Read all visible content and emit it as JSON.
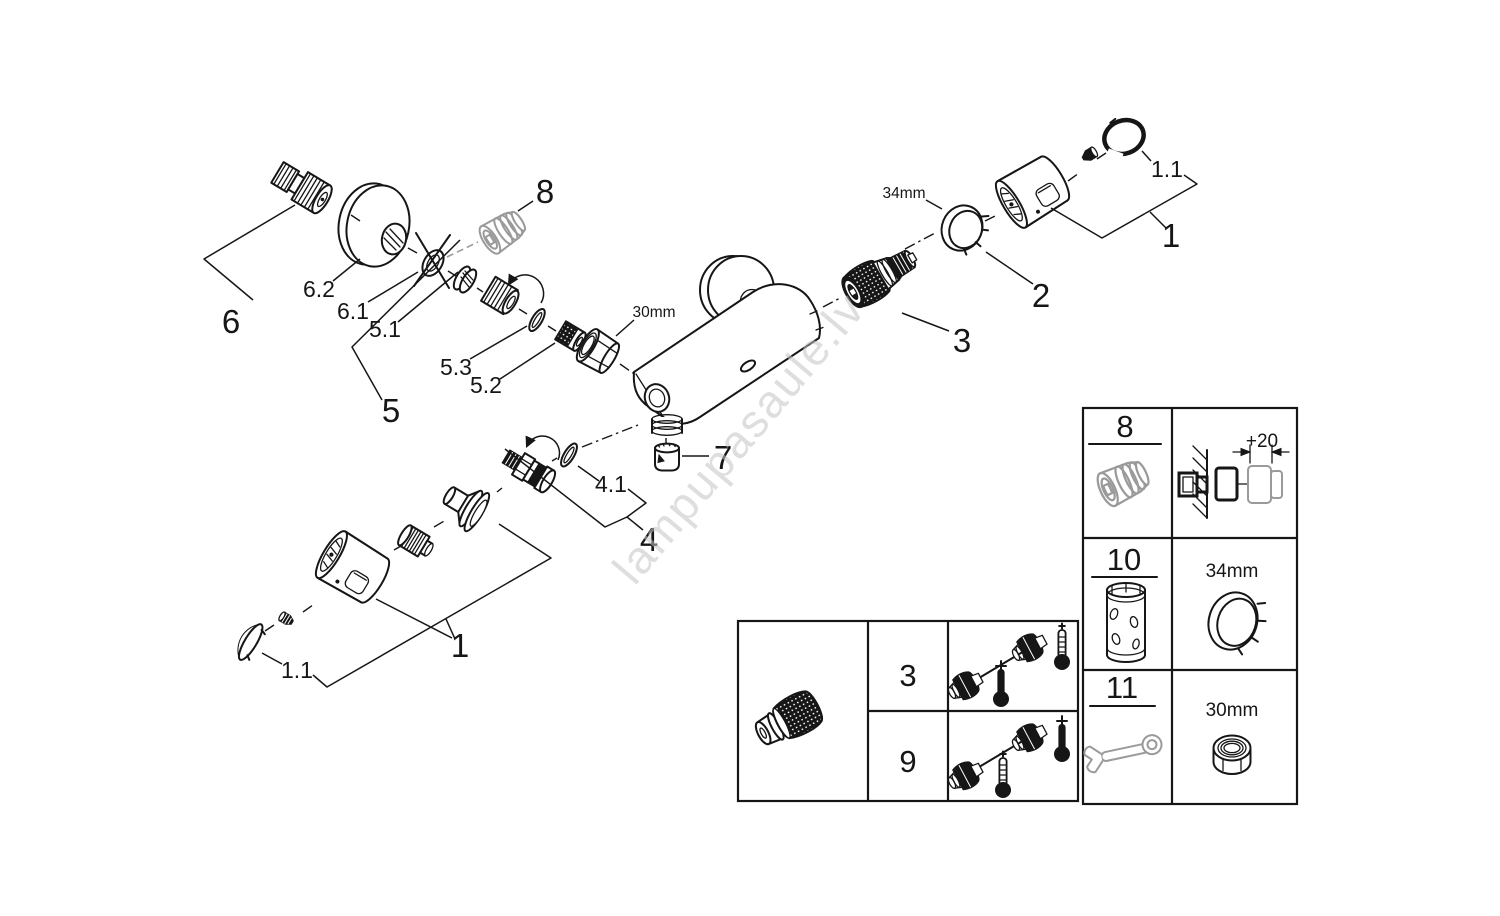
{
  "watermark": {
    "text": "lampupasaule.lv",
    "color": "#c4c4c4"
  },
  "colors": {
    "line": "#161616",
    "gray_part": "#9a9a9a",
    "background": "#ffffff"
  },
  "callouts": {
    "group6": "6",
    "sub6_2": "6.2",
    "sub6_1": "6.1",
    "group5": "5",
    "sub5_1": "5.1",
    "sub5_3": "5.3",
    "sub5_2": "5.2",
    "part8": "8",
    "nut_size": "30mm",
    "part7": "7",
    "group4": "4",
    "sub4_1": "4.1",
    "group1_bottom": "1",
    "sub1_1_bottom": "1.1",
    "part3": "3",
    "part2": "2",
    "ring_size": "34mm",
    "group1_top": "1",
    "sub1_1_top": "1.1"
  },
  "service_table": {
    "rows": [
      {
        "part": "3"
      },
      {
        "part": "9"
      }
    ]
  },
  "tools_table": {
    "rows": [
      {
        "part": "8",
        "note": "+20"
      },
      {
        "part": "10",
        "note": "34mm"
      },
      {
        "part": "11",
        "note": "30mm"
      }
    ]
  }
}
